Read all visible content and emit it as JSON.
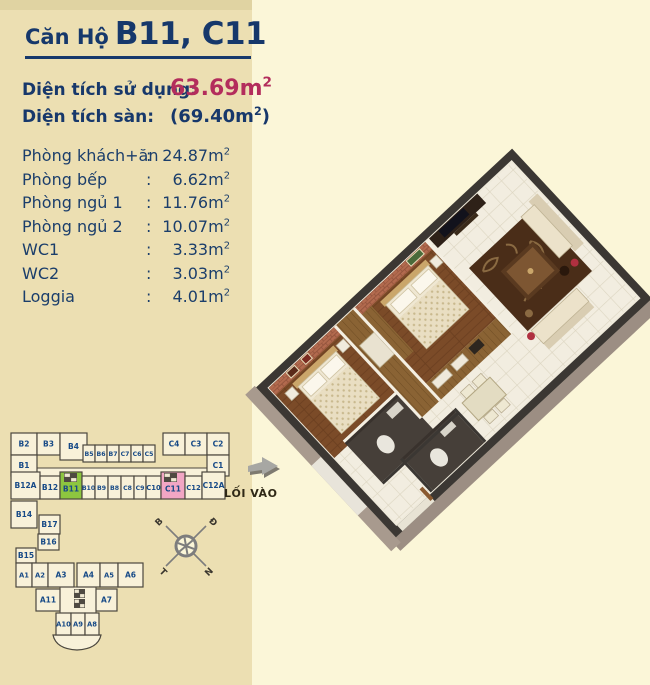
{
  "page": {
    "bg_left": "#ecdfb2",
    "bg_right": "#fbf6d8",
    "accent_navy": "#16386b",
    "accent_red": "#b32d5c",
    "title": {
      "prefix": "Căn Hộ",
      "units": "B11, C11"
    }
  },
  "areas": {
    "usage": {
      "label": "Diện tích sử dụng:",
      "value": "63.69",
      "unit": "m",
      "sup": "2"
    },
    "floor": {
      "label": "Diện tích sàn:",
      "open_paren": "(",
      "value": "69.40",
      "unit": "m",
      "sup": "2",
      "close_paren": ")"
    }
  },
  "rooms": {
    "colon": ":",
    "unit": "m",
    "sup": "2",
    "items": [
      {
        "name": "Phòng khách+ăn",
        "value": "24.87"
      },
      {
        "name": "Phòng bếp",
        "value": "6.62"
      },
      {
        "name": "Phòng ngủ 1",
        "value": "11.76"
      },
      {
        "name": "Phòng ngủ 2",
        "value": "10.07"
      },
      {
        "name": "WC1",
        "value": "3.33"
      },
      {
        "name": "WC2",
        "value": "3.03"
      },
      {
        "name": "Loggia",
        "value": "4.01"
      }
    ]
  },
  "site_map": {
    "cell_fill": "#f8f1d9",
    "cell_stroke": "#4b473e",
    "label_color": "#174a87",
    "highlight_green": "#8dc63f",
    "highlight_pink": "#f2a6c4",
    "units": [
      {
        "id": "B2",
        "x": 3,
        "y": 5,
        "w": 26,
        "h": 22
      },
      {
        "id": "B3",
        "x": 29,
        "y": 5,
        "w": 23,
        "h": 22
      },
      {
        "id": "B4",
        "x": 52,
        "y": 5,
        "w": 27,
        "h": 27
      },
      {
        "id": "B1",
        "x": 3,
        "y": 27,
        "w": 26,
        "h": 21
      },
      {
        "id": "B5",
        "x": 75,
        "y": 17,
        "w": 12,
        "h": 17
      },
      {
        "id": "B6",
        "x": 87,
        "y": 17,
        "w": 12,
        "h": 17
      },
      {
        "id": "B7",
        "x": 99,
        "y": 17,
        "w": 12,
        "h": 17
      },
      {
        "id": "C7",
        "x": 111,
        "y": 17,
        "w": 12,
        "h": 17
      },
      {
        "id": "C6",
        "x": 123,
        "y": 17,
        "w": 12,
        "h": 17
      },
      {
        "id": "C5",
        "x": 135,
        "y": 17,
        "w": 12,
        "h": 17
      },
      {
        "id": "C4",
        "x": 155,
        "y": 5,
        "w": 22,
        "h": 22
      },
      {
        "id": "C3",
        "x": 177,
        "y": 5,
        "w": 22,
        "h": 22
      },
      {
        "id": "C2",
        "x": 199,
        "y": 5,
        "w": 22,
        "h": 22
      },
      {
        "id": "C1",
        "x": 199,
        "y": 27,
        "w": 22,
        "h": 21
      },
      {
        "id": "B12A",
        "x": 3,
        "y": 44,
        "w": 29,
        "h": 27
      },
      {
        "id": "B12",
        "x": 32,
        "y": 48,
        "w": 20,
        "h": 23
      },
      {
        "id": "B11",
        "x": 52,
        "y": 44,
        "w": 22,
        "h": 27,
        "hl": "green"
      },
      {
        "id": "B10",
        "x": 74,
        "y": 48,
        "w": 13,
        "h": 23
      },
      {
        "id": "B9",
        "x": 87,
        "y": 48,
        "w": 13,
        "h": 23
      },
      {
        "id": "B8",
        "x": 100,
        "y": 48,
        "w": 13,
        "h": 23
      },
      {
        "id": "C8",
        "x": 113,
        "y": 48,
        "w": 13,
        "h": 23
      },
      {
        "id": "C9",
        "x": 126,
        "y": 48,
        "w": 12,
        "h": 23
      },
      {
        "id": "C10",
        "x": 138,
        "y": 48,
        "w": 15,
        "h": 23
      },
      {
        "id": "C11",
        "x": 153,
        "y": 44,
        "w": 24,
        "h": 27,
        "hl": "pink"
      },
      {
        "id": "C12",
        "x": 177,
        "y": 48,
        "w": 17,
        "h": 23
      },
      {
        "id": "C12A",
        "x": 194,
        "y": 44,
        "w": 23,
        "h": 27
      },
      {
        "id": "B14",
        "x": 3,
        "y": 73,
        "w": 26,
        "h": 27
      },
      {
        "id": "B17",
        "x": 31,
        "y": 87,
        "w": 21,
        "h": 19
      },
      {
        "id": "B16",
        "x": 30,
        "y": 106,
        "w": 21,
        "h": 16
      },
      {
        "id": "B15",
        "x": 8,
        "y": 120,
        "w": 20,
        "h": 15
      },
      {
        "id": "A1",
        "x": 8,
        "y": 135,
        "w": 16,
        "h": 24
      },
      {
        "id": "A2",
        "x": 24,
        "y": 135,
        "w": 16,
        "h": 24
      },
      {
        "id": "A3",
        "x": 40,
        "y": 135,
        "w": 26,
        "h": 24
      },
      {
        "id": "A4",
        "x": 69,
        "y": 135,
        "w": 23,
        "h": 24
      },
      {
        "id": "A5",
        "x": 92,
        "y": 135,
        "w": 18,
        "h": 24
      },
      {
        "id": "A6",
        "x": 110,
        "y": 135,
        "w": 25,
        "h": 24
      },
      {
        "id": "A11",
        "x": 28,
        "y": 161,
        "w": 24,
        "h": 22
      },
      {
        "id": "A7",
        "x": 88,
        "y": 161,
        "w": 21,
        "h": 22
      },
      {
        "id": "A10",
        "x": 48,
        "y": 185,
        "w": 15,
        "h": 22
      },
      {
        "id": "A9",
        "x": 63,
        "y": 185,
        "w": 14,
        "h": 22
      },
      {
        "id": "A8",
        "x": 77,
        "y": 185,
        "w": 14,
        "h": 22
      }
    ],
    "shafts": [
      {
        "x": 56,
        "y": 45,
        "w": 13,
        "h": 9
      },
      {
        "x": 156,
        "y": 45,
        "w": 13,
        "h": 9
      },
      {
        "x": 66,
        "y": 161,
        "w": 11,
        "h": 9
      },
      {
        "x": 66,
        "y": 171,
        "w": 11,
        "h": 9
      }
    ],
    "compass": {
      "cx": 178,
      "cy": 118,
      "letters": [
        {
          "ch": "B",
          "dx": -1,
          "dy": -1,
          "rot": -45
        },
        {
          "ch": "Đ",
          "dx": 1,
          "dy": -1,
          "rot": 45
        },
        {
          "ch": "T",
          "dx": -1,
          "dy": 1,
          "rot": 45
        },
        {
          "ch": "N",
          "dx": 1,
          "dy": 1,
          "rot": -45
        }
      ]
    },
    "entrance": {
      "label": "LỐI VÀO"
    }
  }
}
